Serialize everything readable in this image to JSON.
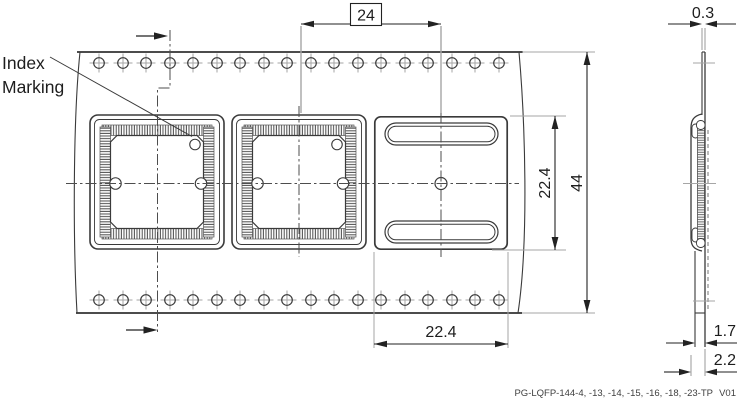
{
  "labels": {
    "index1": "Index",
    "index2": "Marking"
  },
  "dims": {
    "pitch": "24",
    "thickness": "0.3",
    "width": "44",
    "pocket_len": "22.4",
    "pocket_wid": "22.4",
    "depth_inner": "1.7",
    "depth_total": "2.2"
  },
  "footer": {
    "code": "PG-LQFP-144-4, -13, -14, -15, -16, -18, -23-TP",
    "version": "V01"
  },
  "colors": {
    "line": "#3a3a3a",
    "light_line": "#a6a6a6",
    "text": "#1d1d1d",
    "background": "#ffffff"
  }
}
